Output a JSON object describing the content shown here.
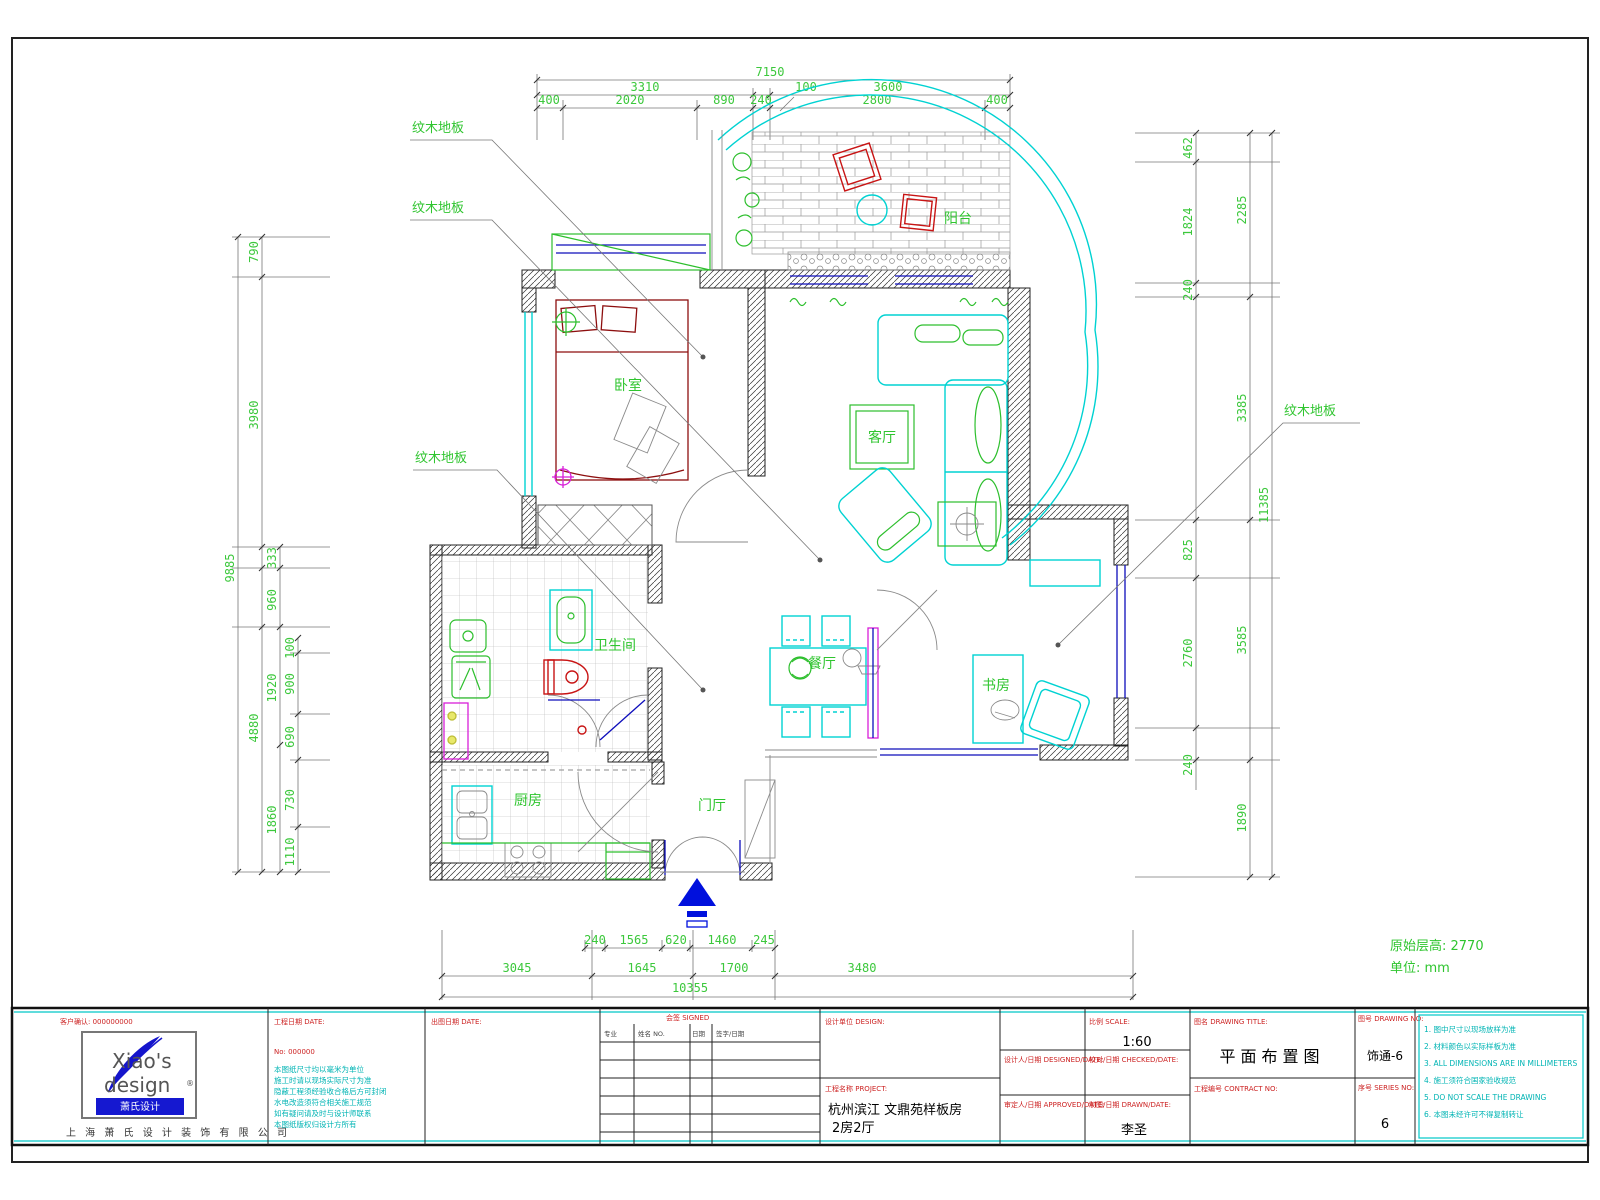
{
  "sheet": {
    "corner_note_line1": "原始层高: 2770",
    "corner_note_line2": "单位: mm"
  },
  "rooms": {
    "bedroom": "卧室",
    "living": "客厅",
    "bath": "卫生间",
    "dining": "餐厅",
    "study": "书房",
    "kitchen": "厨房",
    "entry": "门厅",
    "balcony": "阳台"
  },
  "leaders": {
    "wood_floor": "纹木地板"
  },
  "dims": {
    "top": {
      "total": "7150",
      "r2a": "3310",
      "r2b": "100",
      "r2c": "3600",
      "r3": [
        "400",
        "2020",
        "890",
        "240",
        "2800",
        "400"
      ]
    },
    "bottom": {
      "r1": [
        "240",
        "1565",
        "620",
        "1460",
        "245"
      ],
      "r2": [
        "3045",
        "1645",
        "1700",
        "3480"
      ],
      "total": "10355"
    },
    "left": {
      "outer": "9885",
      "sub": "4880",
      "mid": [
        "790",
        "3980",
        "333",
        "960",
        "1920",
        "1860"
      ],
      "inner": [
        "100",
        "900",
        "690",
        "730",
        "1110"
      ]
    },
    "right": {
      "outer": "11385",
      "mid": [
        "2285",
        "3385",
        "3585",
        "1890"
      ],
      "inner": [
        "462",
        "1824",
        "240",
        "825",
        "2760",
        "240"
      ]
    }
  },
  "title_block": {
    "logo_text1": "Xiao's",
    "logo_text2": "design",
    "logo_reg": "®",
    "logo_banner": "萧氏设计",
    "company_name": "上 海 萧 氏 设 计 装 饰 有 限 公 司",
    "client_label": "客户确认: 000000000",
    "date_label": "工程日期 DATE:",
    "no_label": "No: 000000",
    "issue_label": "出图日期 DATE:",
    "notes_left": [
      "本图纸尺寸均以毫米为单位",
      "施工时请以现场实际尺寸为准",
      "隐蔽工程须经验收合格后方可封闭",
      "水电改造须符合相关施工规范",
      "如有疑问请及时与设计师联系",
      "本图纸版权归设计方所有"
    ],
    "sign_label": "会签 SIGNED",
    "sign_h1": "专业",
    "sign_h2": "姓名 NO.",
    "sign_h3": "日期",
    "sign_h4": "签字/日期",
    "design_unit_label": "设计单位 DESIGN:",
    "project_label": "工程名称 PROJECT:",
    "project_line1": "杭州滨江  文鼎苑样板房",
    "project_line2": "2房2厅",
    "designer_label": "设计人/日期 DESIGNED/DATE:",
    "approver_label": "审定人/日期 APPROVED/DATE:",
    "scale_label": "比例 SCALE:",
    "scale_value": "1:60",
    "check_label": "校对/日期 CHECKED/DATE:",
    "draw_label": "制图/日期 DRAWN/DATE:",
    "drawer_value": "李圣",
    "title_label": "图名 DRAWING TITLE:",
    "title_value": "平面布置图",
    "contract_label": "工程编号 CONTRACT NO:",
    "drawing_no_label": "图号 DRAWING NO:",
    "drawing_no_value": "饰通-6",
    "series_label": "序号 SERIES NO:",
    "series_value": "6",
    "notes_right": [
      "1. 图中尺寸以现场放样为准",
      "2. 材料颜色以实际样板为准",
      "3. ALL DIMENSIONS ARE IN MILLIMETERS",
      "4. 施工须符合国家验收规范",
      "5. DO NOT SCALE THE DRAWING",
      "6. 本图未经许可不得复制转让"
    ]
  }
}
